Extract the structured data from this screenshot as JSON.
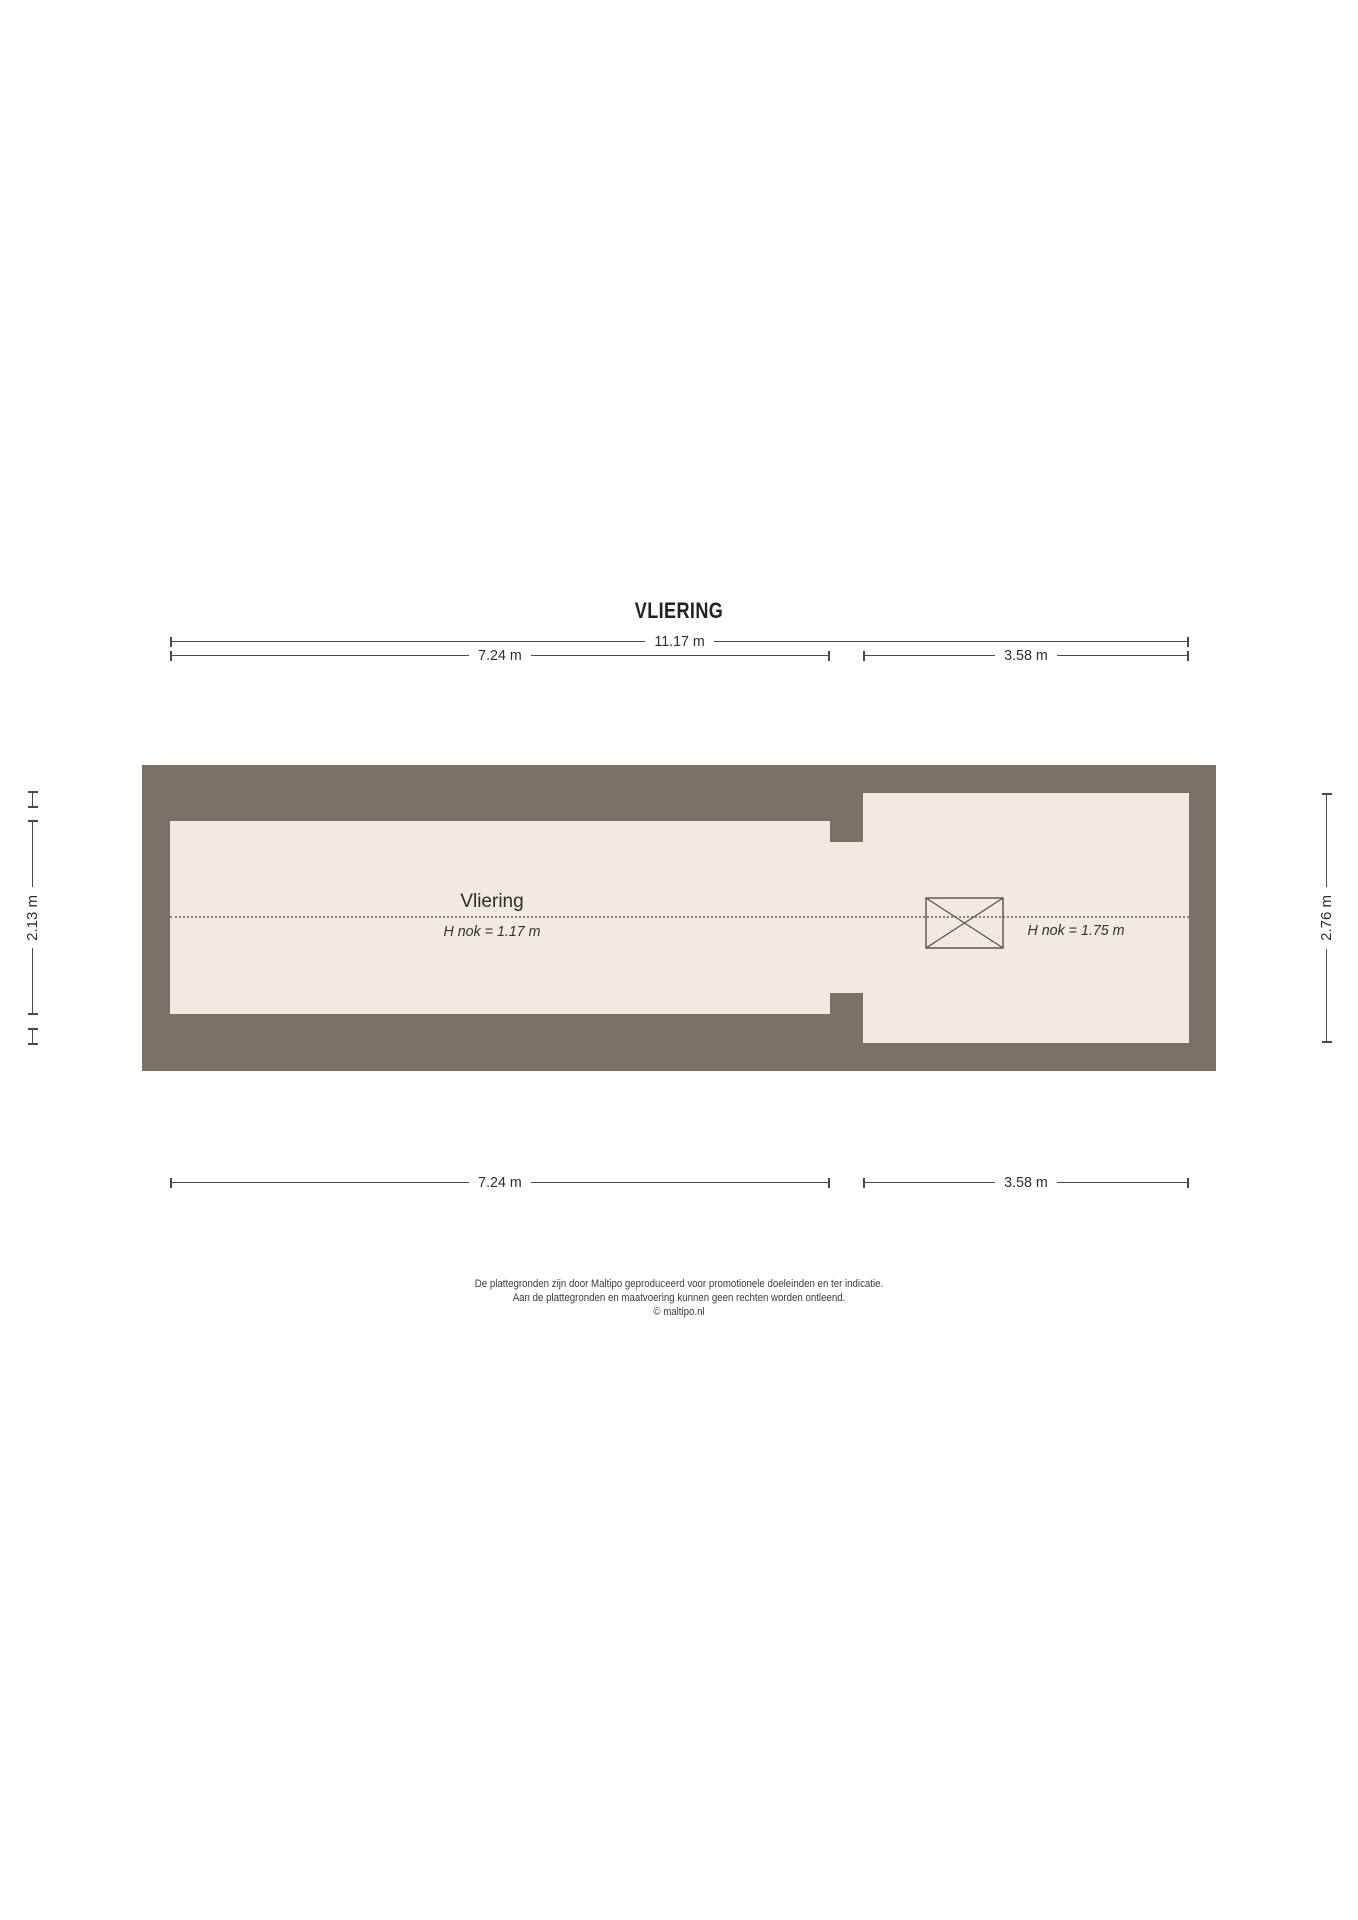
{
  "title": "VLIERING",
  "colors": {
    "wall": "#7b7167",
    "floor": "#f0eae1",
    "line": "#494949",
    "text": "#2d2d2d",
    "ridge": "#8d8579",
    "symbol": "#55504a",
    "page": "#ffffff"
  },
  "dimensions": {
    "top_total": "11.17 m",
    "top_left": "7.24 m",
    "top_right": "3.58 m",
    "bottom_left": "7.24 m",
    "bottom_right": "3.58 m",
    "side_left": "2.13 m",
    "side_right": "2.76 m"
  },
  "rooms": {
    "left": {
      "name": "Vliering",
      "ridge_height": "H nok = 1.17 m"
    },
    "right": {
      "ridge_height": "H nok = 1.75 m"
    }
  },
  "symbols": {
    "roof_window": "crossed-rectangle roof window / skylight"
  },
  "footer": {
    "line1": "De plattegronden zijn door Maltipo geproduceerd voor promotionele doeleinden en ter indicatie.",
    "line2": "Aan de plattegronden en maatvoering kunnen geen rechten worden ontleend.",
    "line3": "© maltipo.nl"
  }
}
